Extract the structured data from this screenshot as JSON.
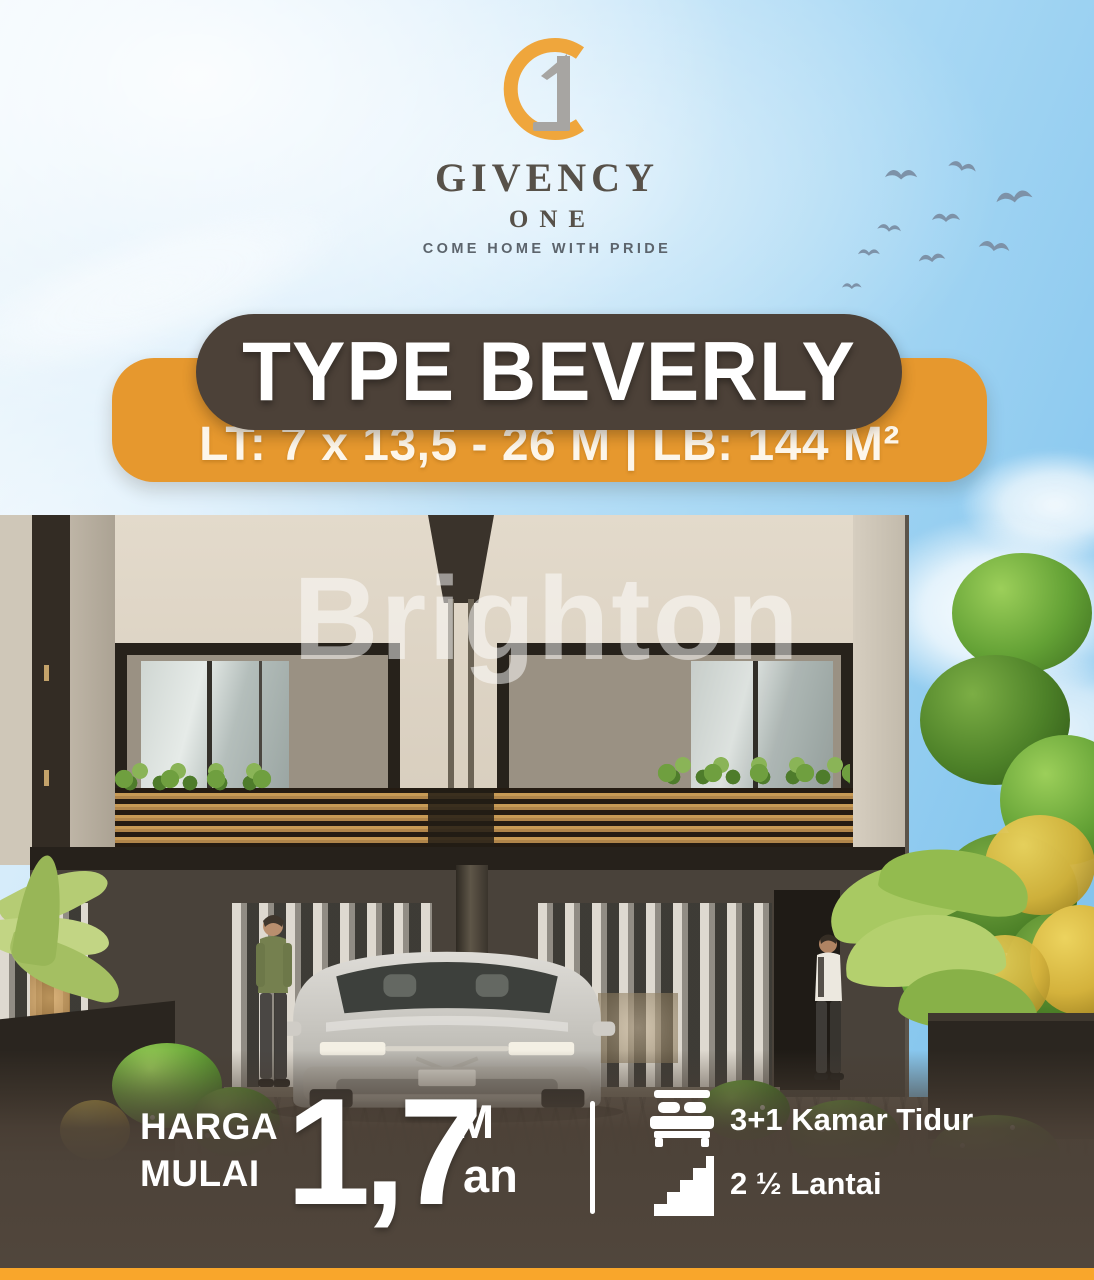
{
  "brand": {
    "name": "GIVENCY",
    "sub": "ONE",
    "tagline": "COME HOME WITH PRIDE",
    "logo_gold": "#EFA63C",
    "logo_gray": "#A7A5A2"
  },
  "banner": {
    "type_label": "TYPE BEVERLY",
    "specs_label": "LT: 7 x 13,5 - 26 M  |  LB: 144 M²",
    "pill_color": "#4C4138",
    "bar_color": "#E6982E"
  },
  "watermark": {
    "text": "Brighton"
  },
  "price": {
    "label_line1": "HARGA",
    "label_line2": "MULAI",
    "value": "1,7",
    "unit_top": "M",
    "unit_bottom": "an"
  },
  "features": [
    {
      "icon": "bed-icon",
      "label": "3+1 Kamar Tidur"
    },
    {
      "icon": "stairs-icon",
      "label": "2 ½ Lantai"
    }
  ],
  "colors": {
    "accent_orange": "#E6982E",
    "bottom_strip_orange": "#F9A62B",
    "pill_brown": "#4C4138",
    "band_brown": "#50453C",
    "sky_blue": "#86C6EE"
  },
  "scene": {
    "alt": "Modern two-storey twin house render with silver car, two residents and garden"
  }
}
